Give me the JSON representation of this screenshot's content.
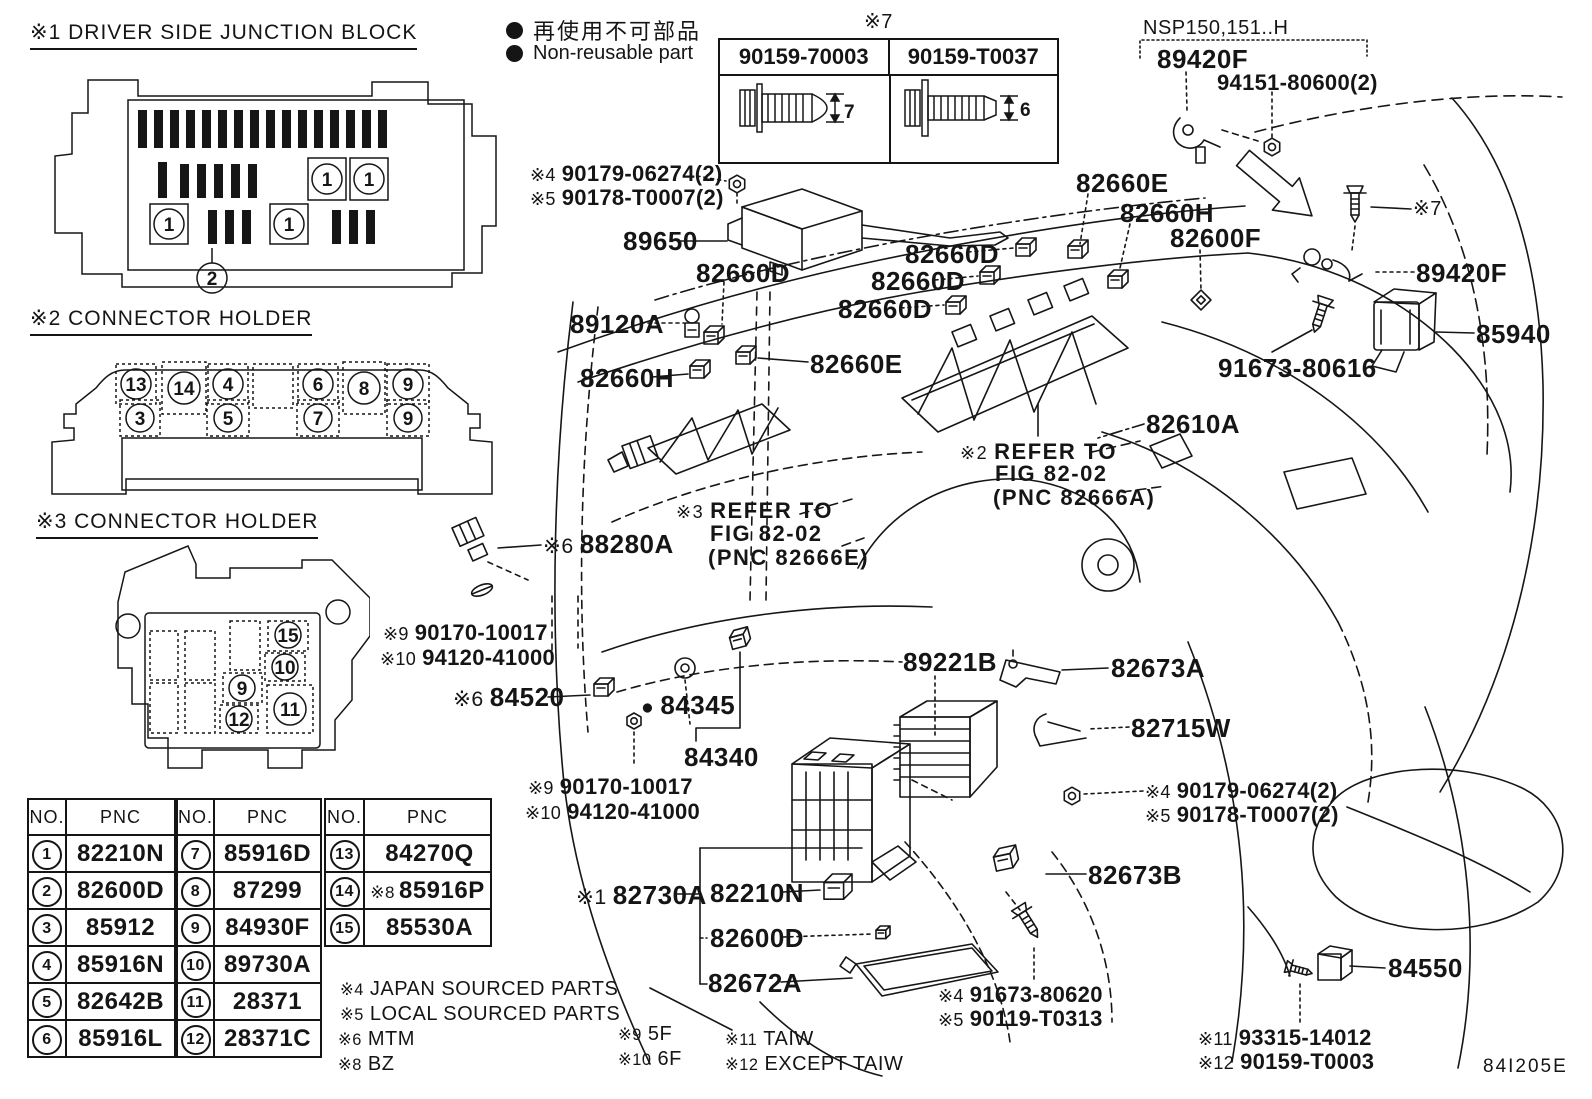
{
  "page": {
    "drawing_code": "84I205E"
  },
  "legend": {
    "bullet": "●",
    "jp": "再使用不可部品",
    "en": "Non-reusable part"
  },
  "sections": {
    "s1": {
      "title": "※1 DRIVER SIDE JUNCTION BLOCK",
      "callouts": [
        "1",
        "1",
        "1",
        "1",
        "2"
      ]
    },
    "s2": {
      "title": "※2 CONNECTOR HOLDER",
      "top": [
        "13",
        "14",
        "4",
        "6",
        "8",
        "9"
      ],
      "bottom": [
        "3",
        "5",
        "7",
        "9"
      ]
    },
    "s3": {
      "title": "※3 CONNECTOR HOLDER",
      "cells": [
        "15",
        "10",
        "9",
        "11",
        "12"
      ]
    }
  },
  "screw_box": {
    "ref": "※7",
    "cols": [
      {
        "part": "90159-70003",
        "dim": "7"
      },
      {
        "part": "90159-T0037",
        "dim": "6"
      }
    ]
  },
  "variant": {
    "model": "NSP150,151..H",
    "part": "89420F",
    "nut": "94151-80600(2)"
  },
  "table": {
    "no_header": "NO.",
    "pnc_header": "PNC",
    "g1": [
      [
        "1",
        "82210N"
      ],
      [
        "2",
        "82600D"
      ],
      [
        "3",
        "85912"
      ],
      [
        "4",
        "85916N"
      ],
      [
        "5",
        "82642B"
      ],
      [
        "6",
        "85916L"
      ]
    ],
    "g2": [
      [
        "7",
        "85916D"
      ],
      [
        "8",
        "87299"
      ],
      [
        "9",
        "84930F"
      ],
      [
        "10",
        "89730A"
      ],
      [
        "11",
        "28371"
      ],
      [
        "12",
        "28371C"
      ]
    ],
    "g3": [
      [
        "13",
        "84270Q",
        ""
      ],
      [
        "14",
        "85916P",
        "※8"
      ],
      [
        "15",
        "85530A",
        ""
      ]
    ]
  },
  "labels": [
    {
      "p": "※4",
      "t": "90179-06274(2)"
    },
    {
      "p": "※5",
      "t": "90178-T0007(2)"
    },
    {
      "t": "89650"
    },
    {
      "t": "82660D"
    },
    {
      "t": "89120A"
    },
    {
      "t": "82660H"
    },
    {
      "t": "82660E"
    },
    {
      "t": "82660E"
    },
    {
      "t": "82660H"
    },
    {
      "t": "82660D"
    },
    {
      "t": "82660D"
    },
    {
      "t": "82660D"
    },
    {
      "t": "82600F"
    },
    {
      "t": "※7"
    },
    {
      "t": "89420F"
    },
    {
      "t": "85940"
    },
    {
      "t": "91673-80616"
    },
    {
      "t": "82610A"
    },
    {
      "p": "※2",
      "t": "REFER TO"
    },
    {
      "t": "FIG 82-02"
    },
    {
      "t": "(PNC 82666A)"
    },
    {
      "p": "※3",
      "t": "REFER TO"
    },
    {
      "t": "FIG 82-02"
    },
    {
      "t": "(PNC 82666E)"
    },
    {
      "p": "※6",
      "t": "88280A"
    },
    {
      "p": "※9",
      "t": "90170-10017"
    },
    {
      "p": "※10",
      "t": "94120-41000"
    },
    {
      "p": "※6",
      "t": "84520"
    },
    {
      "p": "●",
      "t": "84345"
    },
    {
      "t": "84340"
    },
    {
      "t": "89221B"
    },
    {
      "t": "82673A"
    },
    {
      "t": "82715W"
    },
    {
      "p": "※9",
      "t": "90170-10017"
    },
    {
      "p": "※10",
      "t": "94120-41000"
    },
    {
      "p": "※4",
      "t": "90179-06274(2)"
    },
    {
      "p": "※5",
      "t": "90178-T0007(2)"
    },
    {
      "t": "82673B"
    },
    {
      "p": "※1",
      "t": "82730A"
    },
    {
      "t": "82210N"
    },
    {
      "t": "82600D"
    },
    {
      "t": "82672A"
    },
    {
      "p": "※4",
      "t": "91673-80620"
    },
    {
      "p": "※5",
      "t": "90119-T0313"
    },
    {
      "t": "84550"
    },
    {
      "p": "※11",
      "t": "93315-14012"
    },
    {
      "p": "※12",
      "t": "90159-T0003"
    },
    {
      "p": "※9",
      "t": "5F"
    },
    {
      "p": "※10",
      "t": "6F"
    },
    {
      "p": "※11",
      "t": "TAIW"
    },
    {
      "p": "※12",
      "t": "EXCEPT TAIW"
    },
    {
      "p": "※4",
      "t": "JAPAN SOURCED PARTS"
    },
    {
      "p": "※5",
      "t": "LOCAL SOURCED PARTS"
    },
    {
      "p": "※6",
      "t": "MTM"
    },
    {
      "p": "※8",
      "t": "BZ"
    }
  ]
}
